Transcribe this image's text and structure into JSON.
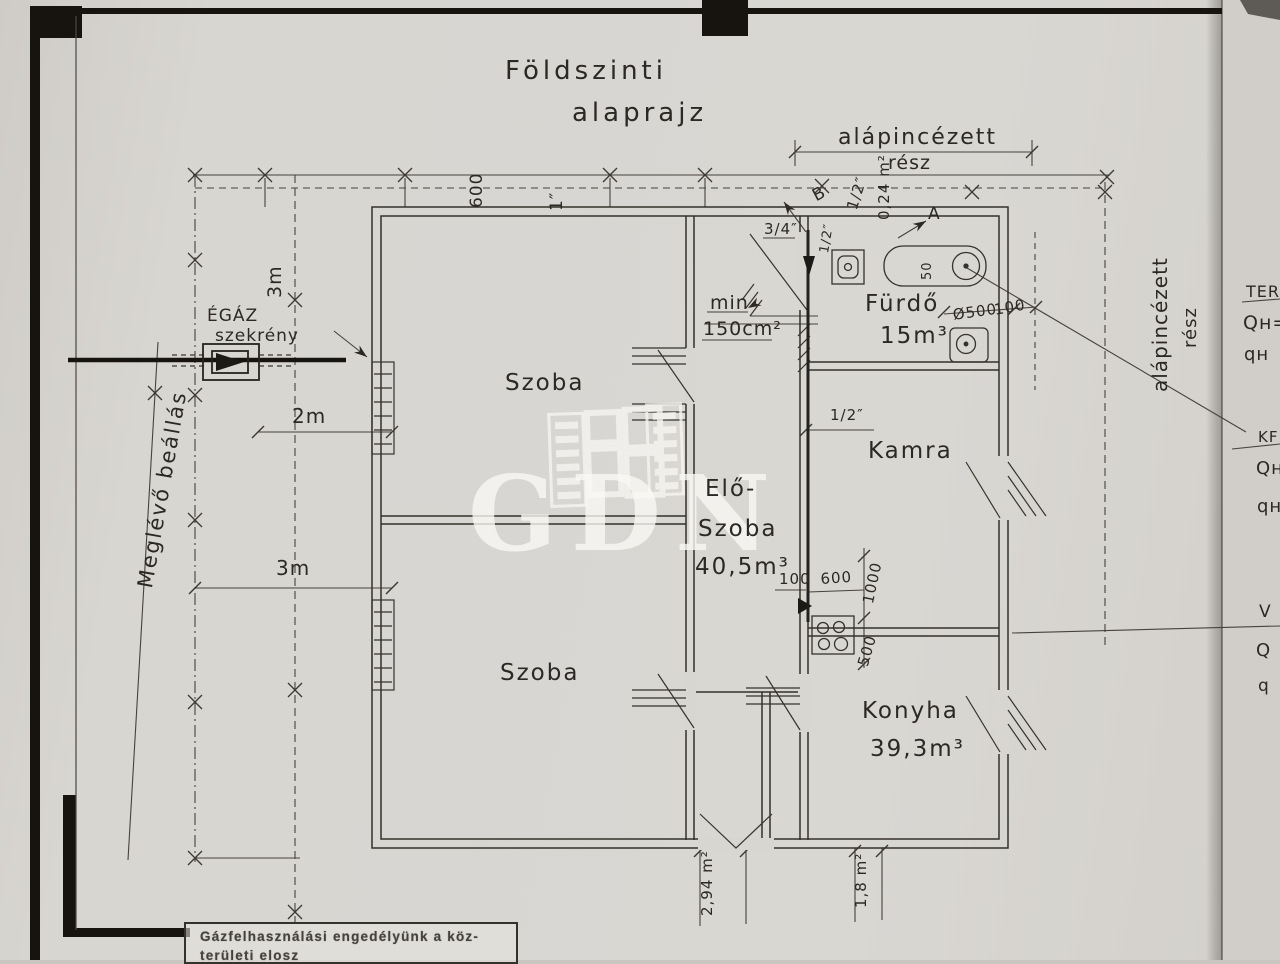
{
  "colors": {
    "paper": "#d8d6d1",
    "ink": "#2c2925",
    "frame": "#17140f",
    "watermark": "#f5f4f0"
  },
  "title": {
    "line1": "Földszinti",
    "line2": "alaprajz"
  },
  "watermark": {
    "text": "GDN"
  },
  "rooms": {
    "szoba_top": {
      "label": "Szoba"
    },
    "szoba_bottom": {
      "label": "Szoba"
    },
    "eloszoba": {
      "line1": "Elő-",
      "line2": "Szoba",
      "volume": "40,5m³"
    },
    "furdo": {
      "label": "Fürdő",
      "volume": "15m³"
    },
    "kamra": {
      "label": "Kamra"
    },
    "konyha": {
      "label": "Konyha",
      "volume": "39,3m³"
    }
  },
  "gas": {
    "cabinet_line1": "ÉGÁZ",
    "cabinet_line2": "szekrény",
    "existing_note": "Meglévő beállás"
  },
  "dims": {
    "basement_top_line1": "alápincézett",
    "basement_top_line2": "rész",
    "basement_right_line1": "alápincézett",
    "basement_right_line2": "rész",
    "top_600": "600",
    "top_1in": "1″",
    "left_3m": "3m",
    "left_2m": "2m",
    "left_3m_b": "3m",
    "vent_min": "min",
    "vent_150": "150cm²",
    "pipe_half_top": "1/2″",
    "pipe_half_small": "1/2″",
    "pipe_threequarters": "3/4″",
    "pipe_half_kamra": "1/2″",
    "area_024": "0,24 m²",
    "tub_dia": "Ø500",
    "tub_100": "100",
    "tub_50": "50",
    "elo_100": "100",
    "kitchen_600": "600",
    "kitchen_1000": "1000",
    "kitchen_500": "500",
    "bottom_294": "2,94 m²",
    "bottom_18": "1,8 m²",
    "point_a": "A",
    "point_b": "B"
  },
  "margin_notes": {
    "ter": "TER",
    "ter_qh": "Qʜ=",
    "ter_qh2": "qʜ",
    "kf": "KF",
    "kf_qh": "Qʜ",
    "kf_qh2": "qʜ",
    "v": "V",
    "v_q": "Q",
    "v_q2": "q"
  },
  "stamp": {
    "line1": "Gázfelhasználási engedélyünk a köz-",
    "line2": "területi elosz"
  }
}
